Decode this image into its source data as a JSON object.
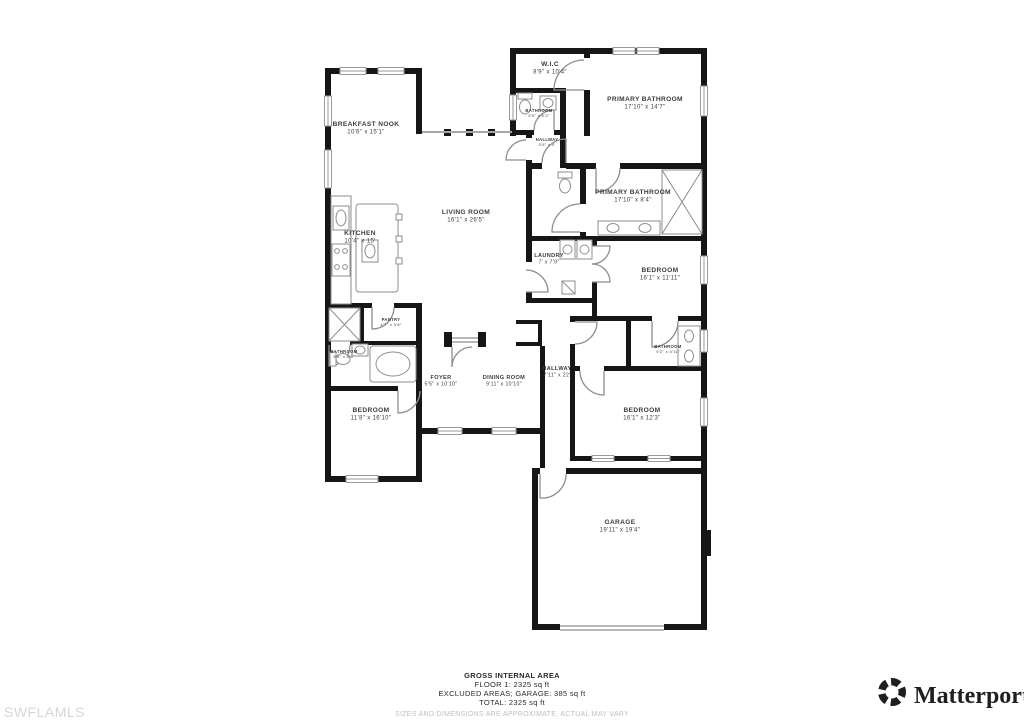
{
  "plan": {
    "title": "Floor plan",
    "rooms": [
      {
        "name": "BREAKFAST NOOK",
        "dims": "10'6\" x 15'1\"",
        "x": 366,
        "y": 126,
        "size": "md"
      },
      {
        "name": "W.I.C",
        "dims": "8'9\" x 10'4\"",
        "x": 550,
        "y": 66,
        "size": "md"
      },
      {
        "name": "PRIMARY BATHROOM",
        "dims": "17'10\" x 14'7\"",
        "x": 645,
        "y": 101,
        "size": "md"
      },
      {
        "name": "BATHROOM",
        "dims": "5'5\" x 5'2\"",
        "x": 539,
        "y": 112,
        "size": "xs"
      },
      {
        "name": "HALLWAY",
        "dims": "3'6\" x 4'",
        "x": 547,
        "y": 141,
        "size": "xs"
      },
      {
        "name": "PRIMARY BATHROOM",
        "dims": "17'10\" x 8'4\"",
        "x": 633,
        "y": 194,
        "size": "md"
      },
      {
        "name": "LIVING ROOM",
        "dims": "16'1\" x 26'5\"",
        "x": 466,
        "y": 214,
        "size": "md"
      },
      {
        "name": "KITCHEN",
        "dims": "10'4\" x 15'",
        "x": 360,
        "y": 235,
        "size": "md"
      },
      {
        "name": "LAUNDRY",
        "dims": "7' x 7'9\"",
        "x": 549,
        "y": 257,
        "size": "sm"
      },
      {
        "name": "BEDROOM",
        "dims": "16'1\" x 11'11\"",
        "x": 660,
        "y": 272,
        "size": "md"
      },
      {
        "name": "PANTRY",
        "dims": "4'7\" x 3'6\"",
        "x": 391,
        "y": 321,
        "size": "xs"
      },
      {
        "name": "BATHROOM",
        "dims": "5'5\" x 8'8\"",
        "x": 344,
        "y": 353,
        "size": "xs"
      },
      {
        "name": "BATHROOM",
        "dims": "9'2\" x 4'11\"",
        "x": 668,
        "y": 348,
        "size": "xs"
      },
      {
        "name": "FOYER",
        "dims": "5'5\" x 10'10\"",
        "x": 441,
        "y": 379,
        "size": "sm"
      },
      {
        "name": "DINING ROOM",
        "dims": "9'11\" x 10'10\"",
        "x": 504,
        "y": 379,
        "size": "sm"
      },
      {
        "name": "HALLWAY",
        "dims": "7'11\" x 22'",
        "x": 557,
        "y": 370,
        "size": "sm"
      },
      {
        "name": "BEDROOM",
        "dims": "11'8\" x 16'10\"",
        "x": 371,
        "y": 412,
        "size": "md"
      },
      {
        "name": "BEDROOM",
        "dims": "16'1\" x 12'3\"",
        "x": 642,
        "y": 412,
        "size": "md"
      },
      {
        "name": "GARAGE",
        "dims": "19'11\" x 19'4\"",
        "x": 620,
        "y": 524,
        "size": "md"
      }
    ]
  },
  "footer": {
    "line1": "GROSS INTERNAL AREA",
    "line2": "FLOOR 1: 2325 sq ft",
    "line3": "EXCLUDED AREAS; GARAGE: 385 sq ft",
    "line4": "TOTAL: 2325 sq ft",
    "disclaimer": "SIZES AND DIMENSIONS ARE APPROXIMATE, ACTUAL MAY VARY"
  },
  "watermark": "SWFLAMLS",
  "brand": {
    "name": "Matterport",
    "trademark": "®"
  },
  "colors": {
    "wall": "#161616",
    "fixture": "#8e8e8e",
    "label": "#3c3c3c",
    "disclaimer": "#c0bfbf",
    "watermark": "#d6d6d6",
    "brand": "#1f1f1f"
  }
}
